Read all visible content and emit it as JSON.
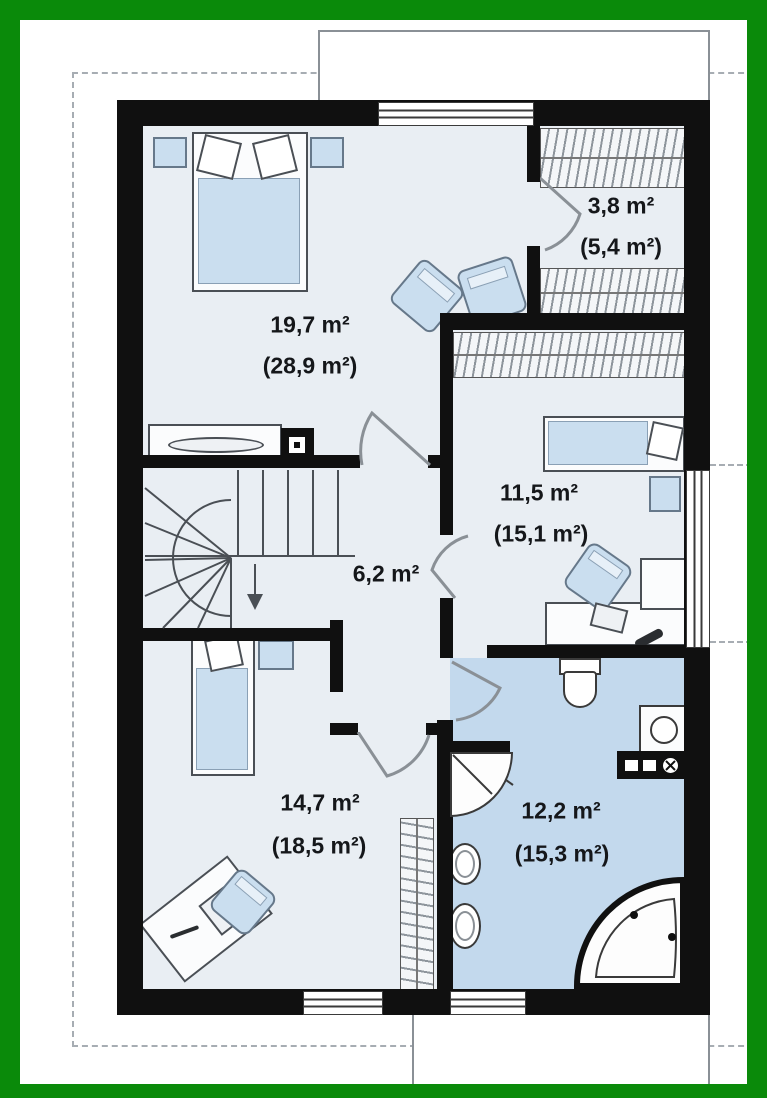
{
  "plan": {
    "unit": "m²",
    "note_area_style": "usable area with gross (attic) area in parentheses"
  },
  "rooms": [
    {
      "name": "bedroom-main",
      "area": "19,7 m²",
      "area_gross": "(28,9 m²)"
    },
    {
      "name": "wardrobe",
      "area": "3,8 m²",
      "area_gross": "(5,4 m²)"
    },
    {
      "name": "bedroom-right",
      "area": "11,5 m²",
      "area_gross": "(15,1 m²)"
    },
    {
      "name": "hallway",
      "area": "6,2 m²"
    },
    {
      "name": "bedroom-lower",
      "area": "14,7 m²",
      "area_gross": "(18,5 m²)"
    },
    {
      "name": "bathroom",
      "area": "12,2 m²",
      "area_gross": "(15,3 m²)"
    }
  ],
  "colors": {
    "frame_green": "#0a8a0a",
    "wall_black": "#101010",
    "room_floor": "#e9eef3",
    "bathroom_floor": "#c3d9ed",
    "furniture_blue": "#cadeef",
    "dashed_gray": "#a7adb3"
  }
}
